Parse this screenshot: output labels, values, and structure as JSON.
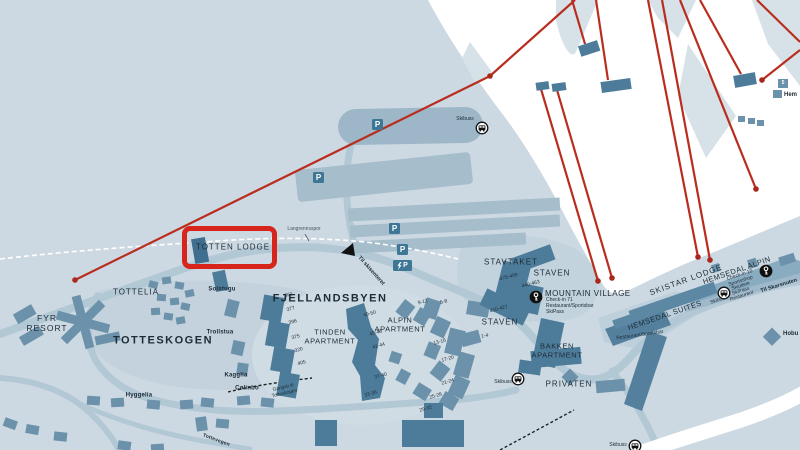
{
  "colors": {
    "highlight_red": "#d8251c",
    "lift_red": "#b92d1f",
    "building": "#6b92aa",
    "building_dark": "#4d7c9a",
    "background": "#cdd9e2",
    "road": "#b3c8d5",
    "text": "#1c2b36",
    "parking_icon": "#3e7795"
  },
  "labels": {
    "totten_lodge": "TOTTEN LODGE",
    "solstugu": "Solstugu",
    "tottelia": "TOTTELIA",
    "fyr_resort": "FYR\nRESORT",
    "totteskogen": "TOTTESKOGEN",
    "trollstua": "Trollstua",
    "kagglia": "Kagglia",
    "colinbo": "Cølinbo",
    "hyggelia": "Hyggelia",
    "fjellandsbyen": "FJELLANDSBYEN",
    "tinden": "TINDEN\nAPARTMENT",
    "alpin": "ALPIN\nAPARTMENT",
    "stavtaket": "STAVTAKET",
    "staven": "STAVEN",
    "mountain_village": "MOUNTAIN VILLAGE",
    "bakken": "BAKKEN\nAPARTMENT",
    "privaten": "PRIVATEN",
    "skistar_lodge": "SKISTAR LODGE",
    "hemsedal_alpin": "HEMSEDAL ALPIN",
    "hemsedal_suites": "HEMSEDAL SUITES"
  },
  "services": {
    "mountain_village": [
      "Check-in 71",
      "Restaurant/Sportsbar",
      "SkiPass"
    ],
    "hemsedal_alpin": [
      "Check-in 10",
      "Sportsshop",
      "Skiutleie",
      "SkiPass",
      "Restaurant"
    ],
    "hemsedal_suites": "Restaurant/Sportsbar"
  },
  "units": {
    "fjell_left": [
      "361",
      "377",
      "396",
      "375",
      "320",
      "405"
    ],
    "tinden": [
      "49-50",
      "45-48",
      "41-44",
      "37-40",
      "33-36"
    ],
    "alpin": [
      "9-12",
      "5-8",
      "13-16",
      "17-20",
      "21-24",
      "25-28",
      "29-32",
      "1-4"
    ],
    "staven": [
      "475-499",
      "440-463",
      "410-427"
    ]
  },
  "roads": {
    "til_skisenteret": "Til skisenteret",
    "til_skarsnuten": "Til Skarsnuten",
    "langrennsspor": "Langrennsspor",
    "gangsti": "Gangsti til\nTotteskogen",
    "tottevegen": "Tottevegen",
    "skibuss": "Skibuss"
  },
  "icons": {
    "parking": "P",
    "legend_5": "5"
  },
  "edge_labels": {
    "hem": "Hem",
    "hobu": "Hobu"
  }
}
